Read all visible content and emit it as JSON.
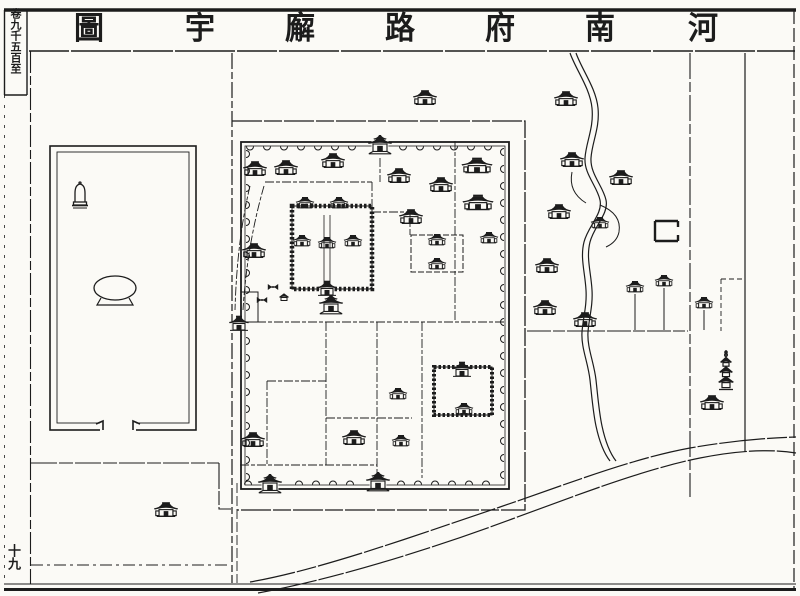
{
  "page": {
    "title": "河南府路廨宇圖",
    "title_chars_left_to_right": [
      "圖",
      "宇",
      "廨",
      "路",
      "府",
      "南",
      "河"
    ],
    "margin_label": "卷九千五百至",
    "page_number": "十九",
    "colors": {
      "ink": "#1c1c1c",
      "paper": "#fbfaf6"
    }
  },
  "map": {
    "river_d": "M570,53 C576,70 590,88 592,108 C594,128 586,142 585,158 C584,174 597,186 600,200 C603,214 588,226 584,242 C580,258 585,272 586,290 C587,306 583,318 582,332 C581,348 588,362 590,380 C592,398 593,412 596,426 C599,440 603,452 610,461",
    "river_branch_d": "M600,205 Q622,214 619,232 Q617,242 606,247",
    "river_spur_d": "M572,172 Q568,192 586,203",
    "cross_road_d": "M527,331 H688",
    "curve_road_upper_d": "M250,582 C320,570 420,534 500,507 C565,485 630,459 690,448 C730,441 765,438 796,437",
    "curve_road_lower_d": "M258,593 C340,578 440,546 512,519 C580,494 645,469 700,458 C740,450 772,449 796,453",
    "south_road_d": "M31,565 H228",
    "buildings": [
      {
        "x": 425,
        "y": 98,
        "t": "hall"
      },
      {
        "x": 255,
        "y": 169,
        "t": "hall"
      },
      {
        "x": 286,
        "y": 168,
        "t": "hall"
      },
      {
        "x": 333,
        "y": 161,
        "t": "hall"
      },
      {
        "x": 399,
        "y": 176,
        "t": "hall"
      },
      {
        "x": 441,
        "y": 185,
        "t": "hall"
      },
      {
        "x": 477,
        "y": 166,
        "t": "wide"
      },
      {
        "x": 478,
        "y": 203,
        "t": "wide"
      },
      {
        "x": 411,
        "y": 217,
        "t": "hall"
      },
      {
        "x": 489,
        "y": 238,
        "t": "small"
      },
      {
        "x": 254,
        "y": 251,
        "t": "hall"
      },
      {
        "x": 305,
        "y": 203,
        "t": "small"
      },
      {
        "x": 339,
        "y": 203,
        "t": "small"
      },
      {
        "x": 302,
        "y": 241,
        "t": "small"
      },
      {
        "x": 327,
        "y": 243,
        "t": "small"
      },
      {
        "x": 353,
        "y": 241,
        "t": "small"
      },
      {
        "x": 327,
        "y": 288,
        "t": "gate-small"
      },
      {
        "x": 331,
        "y": 304,
        "t": "gate"
      },
      {
        "x": 437,
        "y": 240,
        "t": "small"
      },
      {
        "x": 437,
        "y": 264,
        "t": "small"
      },
      {
        "x": 462,
        "y": 369,
        "t": "gate-small"
      },
      {
        "x": 464,
        "y": 409,
        "t": "small"
      },
      {
        "x": 398,
        "y": 394,
        "t": "small"
      },
      {
        "x": 354,
        "y": 438,
        "t": "hall"
      },
      {
        "x": 401,
        "y": 441,
        "t": "small"
      },
      {
        "x": 253,
        "y": 440,
        "t": "hall"
      },
      {
        "x": 270,
        "y": 483,
        "t": "gate"
      },
      {
        "x": 378,
        "y": 481,
        "t": "gate"
      },
      {
        "x": 380,
        "y": 144,
        "t": "gate"
      },
      {
        "x": 239,
        "y": 323,
        "t": "gate-small"
      },
      {
        "x": 273,
        "y": 287,
        "t": "table"
      },
      {
        "x": 262,
        "y": 300,
        "t": "table"
      },
      {
        "x": 284,
        "y": 297,
        "t": "hut"
      },
      {
        "x": 80,
        "y": 196,
        "t": "bell"
      },
      {
        "x": 166,
        "y": 510,
        "t": "hall"
      },
      {
        "x": 566,
        "y": 99,
        "t": "hall"
      },
      {
        "x": 572,
        "y": 160,
        "t": "hall"
      },
      {
        "x": 621,
        "y": 178,
        "t": "hall"
      },
      {
        "x": 559,
        "y": 212,
        "t": "hall"
      },
      {
        "x": 600,
        "y": 223,
        "t": "small"
      },
      {
        "x": 547,
        "y": 266,
        "t": "hall"
      },
      {
        "x": 545,
        "y": 308,
        "t": "hall"
      },
      {
        "x": 635,
        "y": 287,
        "t": "small"
      },
      {
        "x": 664,
        "y": 281,
        "t": "small"
      },
      {
        "x": 704,
        "y": 303,
        "t": "small"
      },
      {
        "x": 585,
        "y": 320,
        "t": "hall"
      },
      {
        "x": 712,
        "y": 403,
        "t": "hall"
      },
      {
        "x": 726,
        "y": 371,
        "t": "pagoda"
      }
    ],
    "poles": [
      [
        635,
        294,
        330
      ],
      [
        664,
        288,
        330
      ],
      [
        704,
        310,
        330
      ]
    ]
  }
}
